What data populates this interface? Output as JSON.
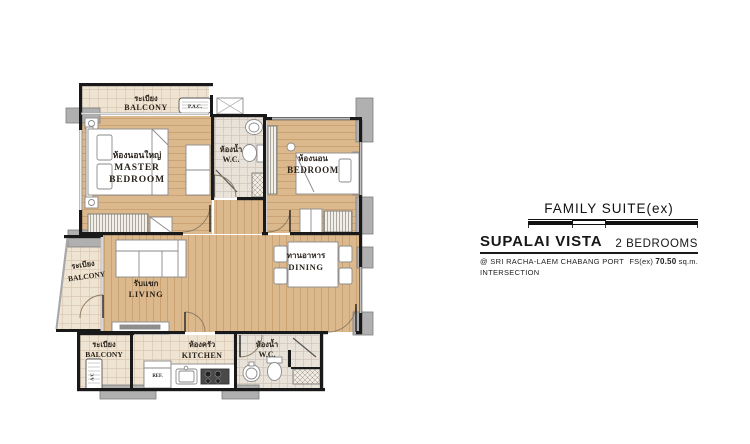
{
  "project": {
    "unit_type": "FAMILY SUITE(ex)",
    "name": "SUPALAI VISTA",
    "bedrooms": "2 BEDROOMS",
    "location_line1": "@ SRI RACHA-LAEM CHABANG PORT",
    "location_line2": "INTERSECTION",
    "area_prefix": "FS(ex)",
    "area_value": "70.50",
    "area_unit": "sq.m."
  },
  "rooms": {
    "balcony_top": {
      "th": "ระเบียง",
      "en": "BALCONY"
    },
    "master_bedroom": {
      "th": "ห้องนอนใหญ่",
      "en1": "MASTER",
      "en2": "BEDROOM"
    },
    "wc_top": {
      "th": "ห้องน้ำ",
      "en": "W.C."
    },
    "bedroom": {
      "th": "ห้องนอน",
      "en": "BEDROOM"
    },
    "living": {
      "th": "รับแขก",
      "en": "LIVING"
    },
    "dining": {
      "th": "ทานอาหาร",
      "en": "DINING"
    },
    "balcony_left": {
      "th": "ระเบียง",
      "en": "BALCONY"
    },
    "balcony_bottom": {
      "th": "ระเบียง",
      "en": "BALCONY"
    },
    "kitchen": {
      "th": "ห้องครัว",
      "en": "KITCHEN"
    },
    "wc_bottom": {
      "th": "ห้องน้ำ",
      "en": "W.C."
    }
  },
  "fixtures": {
    "pac": "P.A.C.",
    "ref": "REF.",
    "ac": "A/C"
  },
  "colors": {
    "wood": "#d9b58a",
    "tile": "#efe3d2",
    "wall": "#191919",
    "column": "#b0b0b0"
  }
}
